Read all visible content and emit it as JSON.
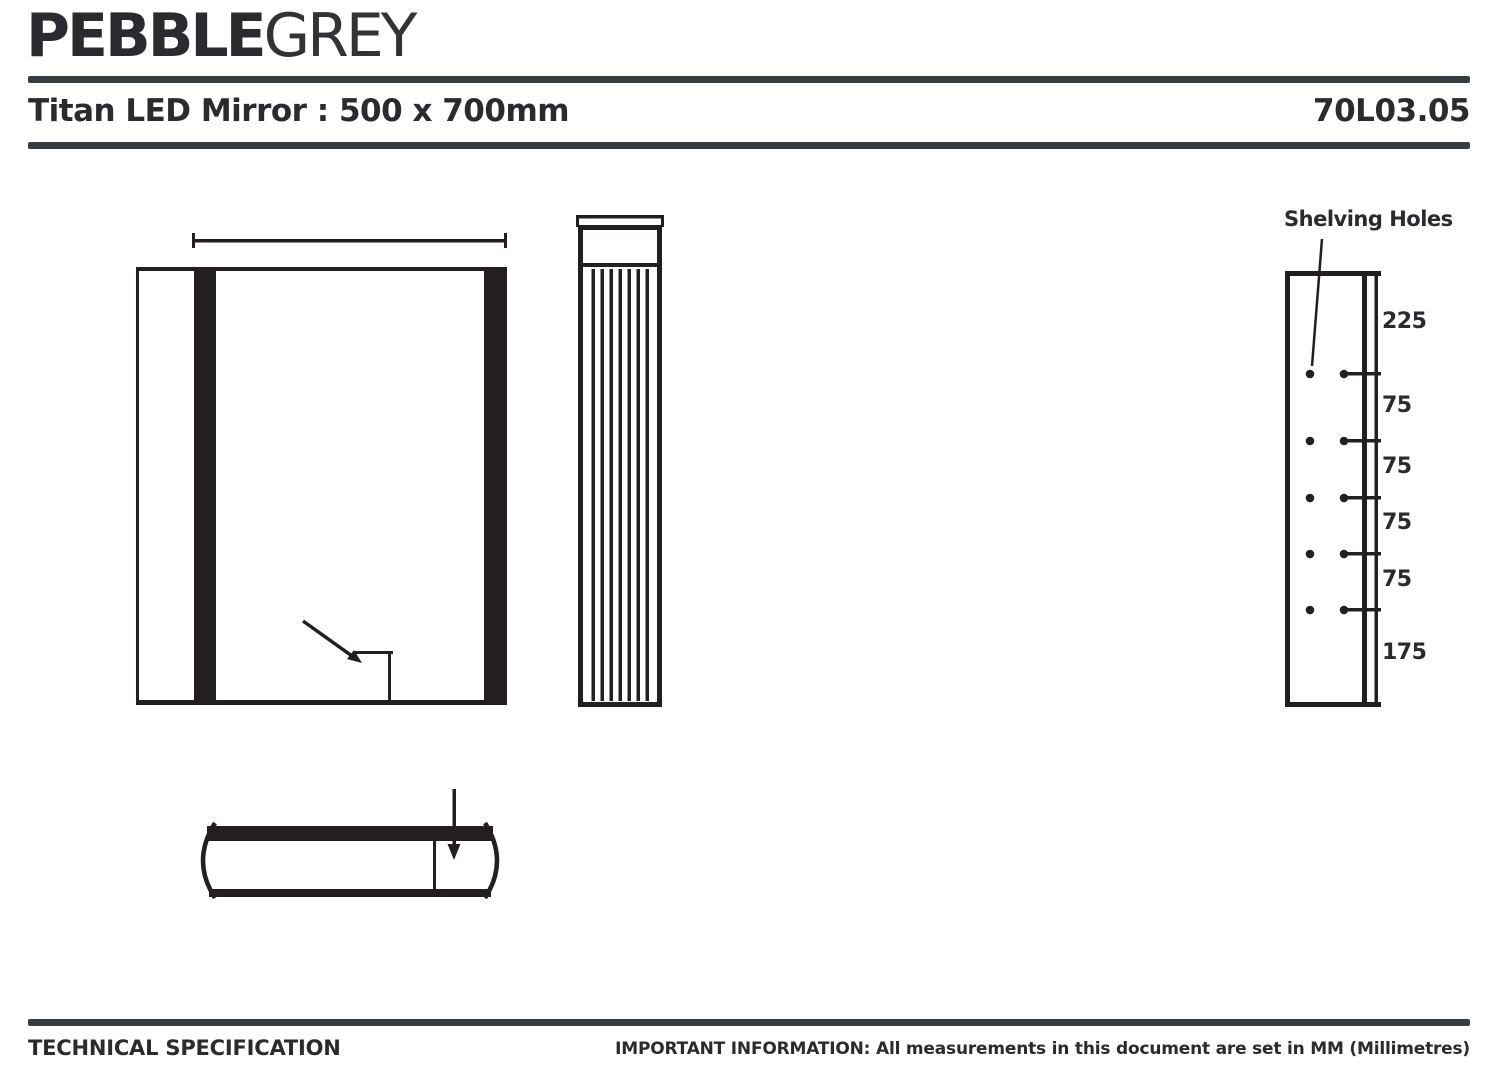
{
  "brand": {
    "pebble": "PEBBLE",
    "grey": "GREY"
  },
  "header": {
    "title": "Titan LED Mirror : 500 x 700mm",
    "code": "70L03.05"
  },
  "shelving": {
    "label": "Shelving Holes",
    "dims": [
      "225",
      "75",
      "75",
      "75",
      "75",
      "175"
    ]
  },
  "footer": {
    "left": "TECHNICAL SPECIFICATION",
    "note_prefix": "IMPORTANT INFORMATION:",
    "note_rest": " All measurements in this document are set in MM (Millimetres)"
  },
  "colors": {
    "ink": "#231f20",
    "text": "#2b2a2e",
    "rule": "#383b40",
    "background": "#ffffff"
  }
}
